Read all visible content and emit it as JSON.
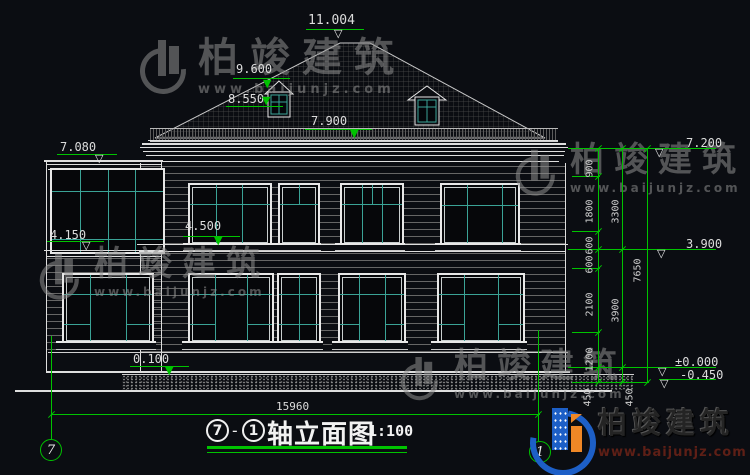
{
  "title": {
    "axis_start": "7",
    "separator": "-",
    "axis_end": "1",
    "name": "轴立面图",
    "scale": "1:100"
  },
  "axes": {
    "left_bubble": "7",
    "right_bubble": "1"
  },
  "levels": {
    "ridge": "11.004",
    "dormer_top": "9.600",
    "dormer_sill": "8.550",
    "eave": "7.900",
    "annex_roof": "7.080",
    "floor2_window_sill": "4.500",
    "annex_sill": "4.150",
    "plinth": "0.100",
    "right_eave": "7.200",
    "right_floor2": "3.900",
    "ground_zero": "±0.000",
    "ground_below": "-0.450"
  },
  "dimensions": {
    "total_width": "15960",
    "total_height": "7650",
    "right_inner_chain": [
      "900",
      "1800",
      "600",
      "600",
      "2100",
      "1200",
      "450"
    ],
    "right_outer_chain": [
      "3300",
      "3900",
      "450"
    ]
  },
  "watermark": {
    "brand": "柏竣建筑",
    "site": "www.baijunjz.com"
  },
  "logo": {
    "brand": "柏竣建筑",
    "site": "www.baijunjz.com"
  },
  "colors": {
    "background": "#0b0d12",
    "line_white": "#e6e6e6",
    "dim_green": "#00c300",
    "mullion_teal": "#3aa396",
    "siding_gray": "#666666",
    "logo_blue": "#1d5fc7",
    "logo_orange": "#ef8726"
  }
}
